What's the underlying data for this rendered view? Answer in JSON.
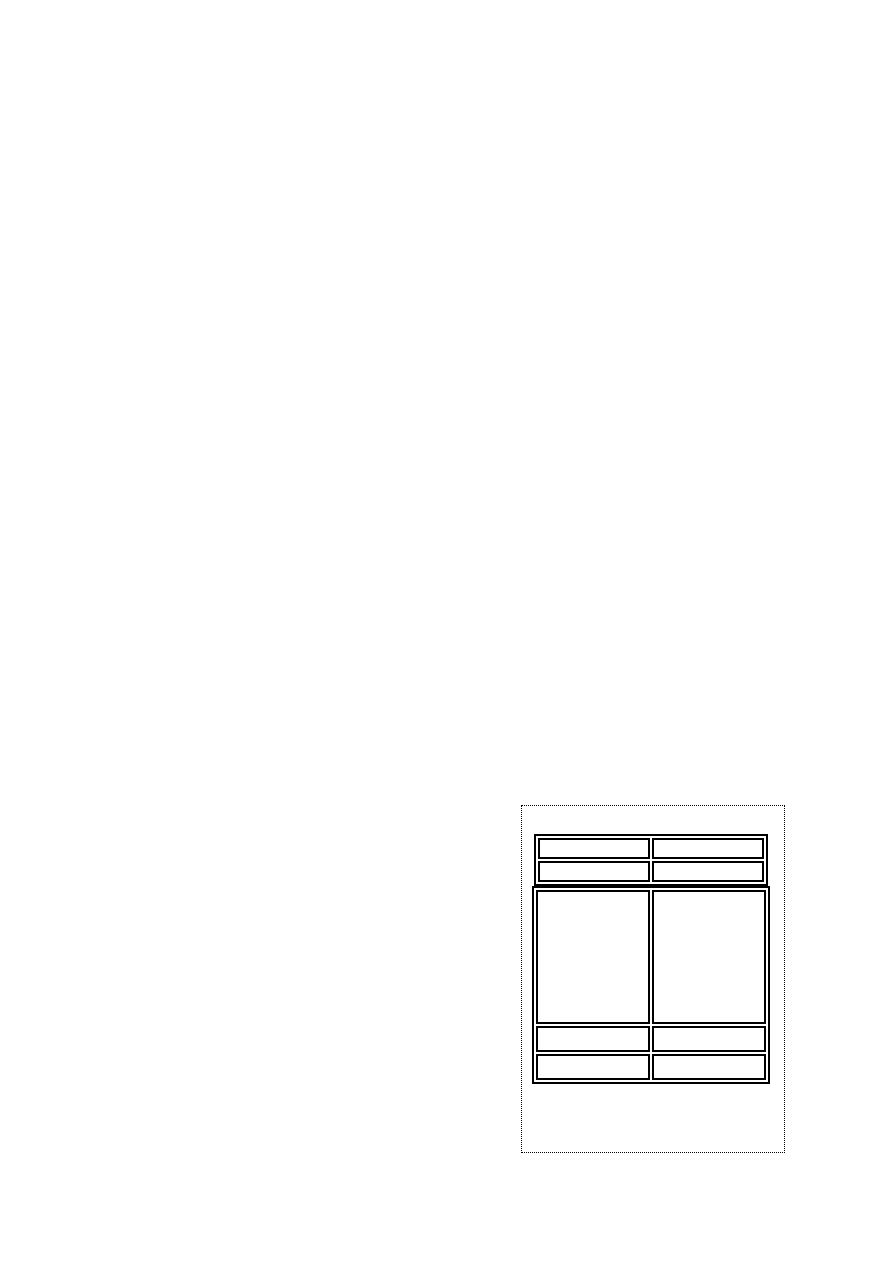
{
  "page": {
    "background_color": "#ffffff"
  },
  "frame": {
    "border_color": "#000000",
    "border_style": "dotted"
  },
  "table": {
    "border_color": "#000000",
    "columns": 2,
    "header_rows": [
      {
        "cells": [
          "",
          ""
        ]
      },
      {
        "cells": [
          "",
          ""
        ]
      }
    ],
    "ruled_block": {
      "lines_per_column": 5,
      "left_rule_weight_px": 1,
      "right_rule_weight_px": 2,
      "cells": [
        "",
        ""
      ]
    },
    "footer_rows": [
      {
        "cells": [
          "",
          ""
        ]
      },
      {
        "cells": [
          "",
          ""
        ]
      }
    ]
  }
}
